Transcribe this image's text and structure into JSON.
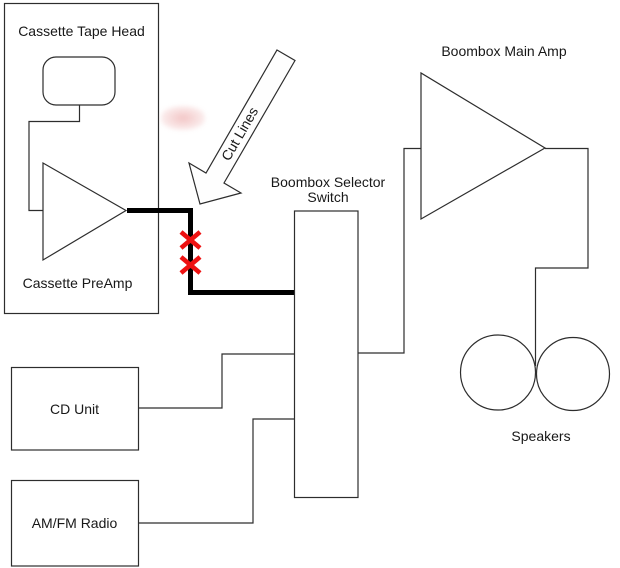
{
  "diagram": {
    "cassette_tape_head": {
      "label": "Cassette Tape Head"
    },
    "cassette_preamp": {
      "label": "Cassette PreAmp"
    },
    "cut_lines": {
      "label": "Cut Lines"
    },
    "selector_switch": {
      "label_line1": "Boombox Selector",
      "label_line2": "Switch"
    },
    "main_amp": {
      "label": "Boombox Main Amp"
    },
    "speakers": {
      "label": "Speakers"
    },
    "cd_unit": {
      "label": "CD Unit"
    },
    "am_fm_radio": {
      "label": "AM/FM Radio"
    },
    "cut_marks": {
      "count": 2
    },
    "colors": {
      "background": "#ffffff",
      "line": "#2d2d2d",
      "wire_thick": "#000000",
      "cut_mark": "#ee1111",
      "text": "#181818"
    }
  }
}
